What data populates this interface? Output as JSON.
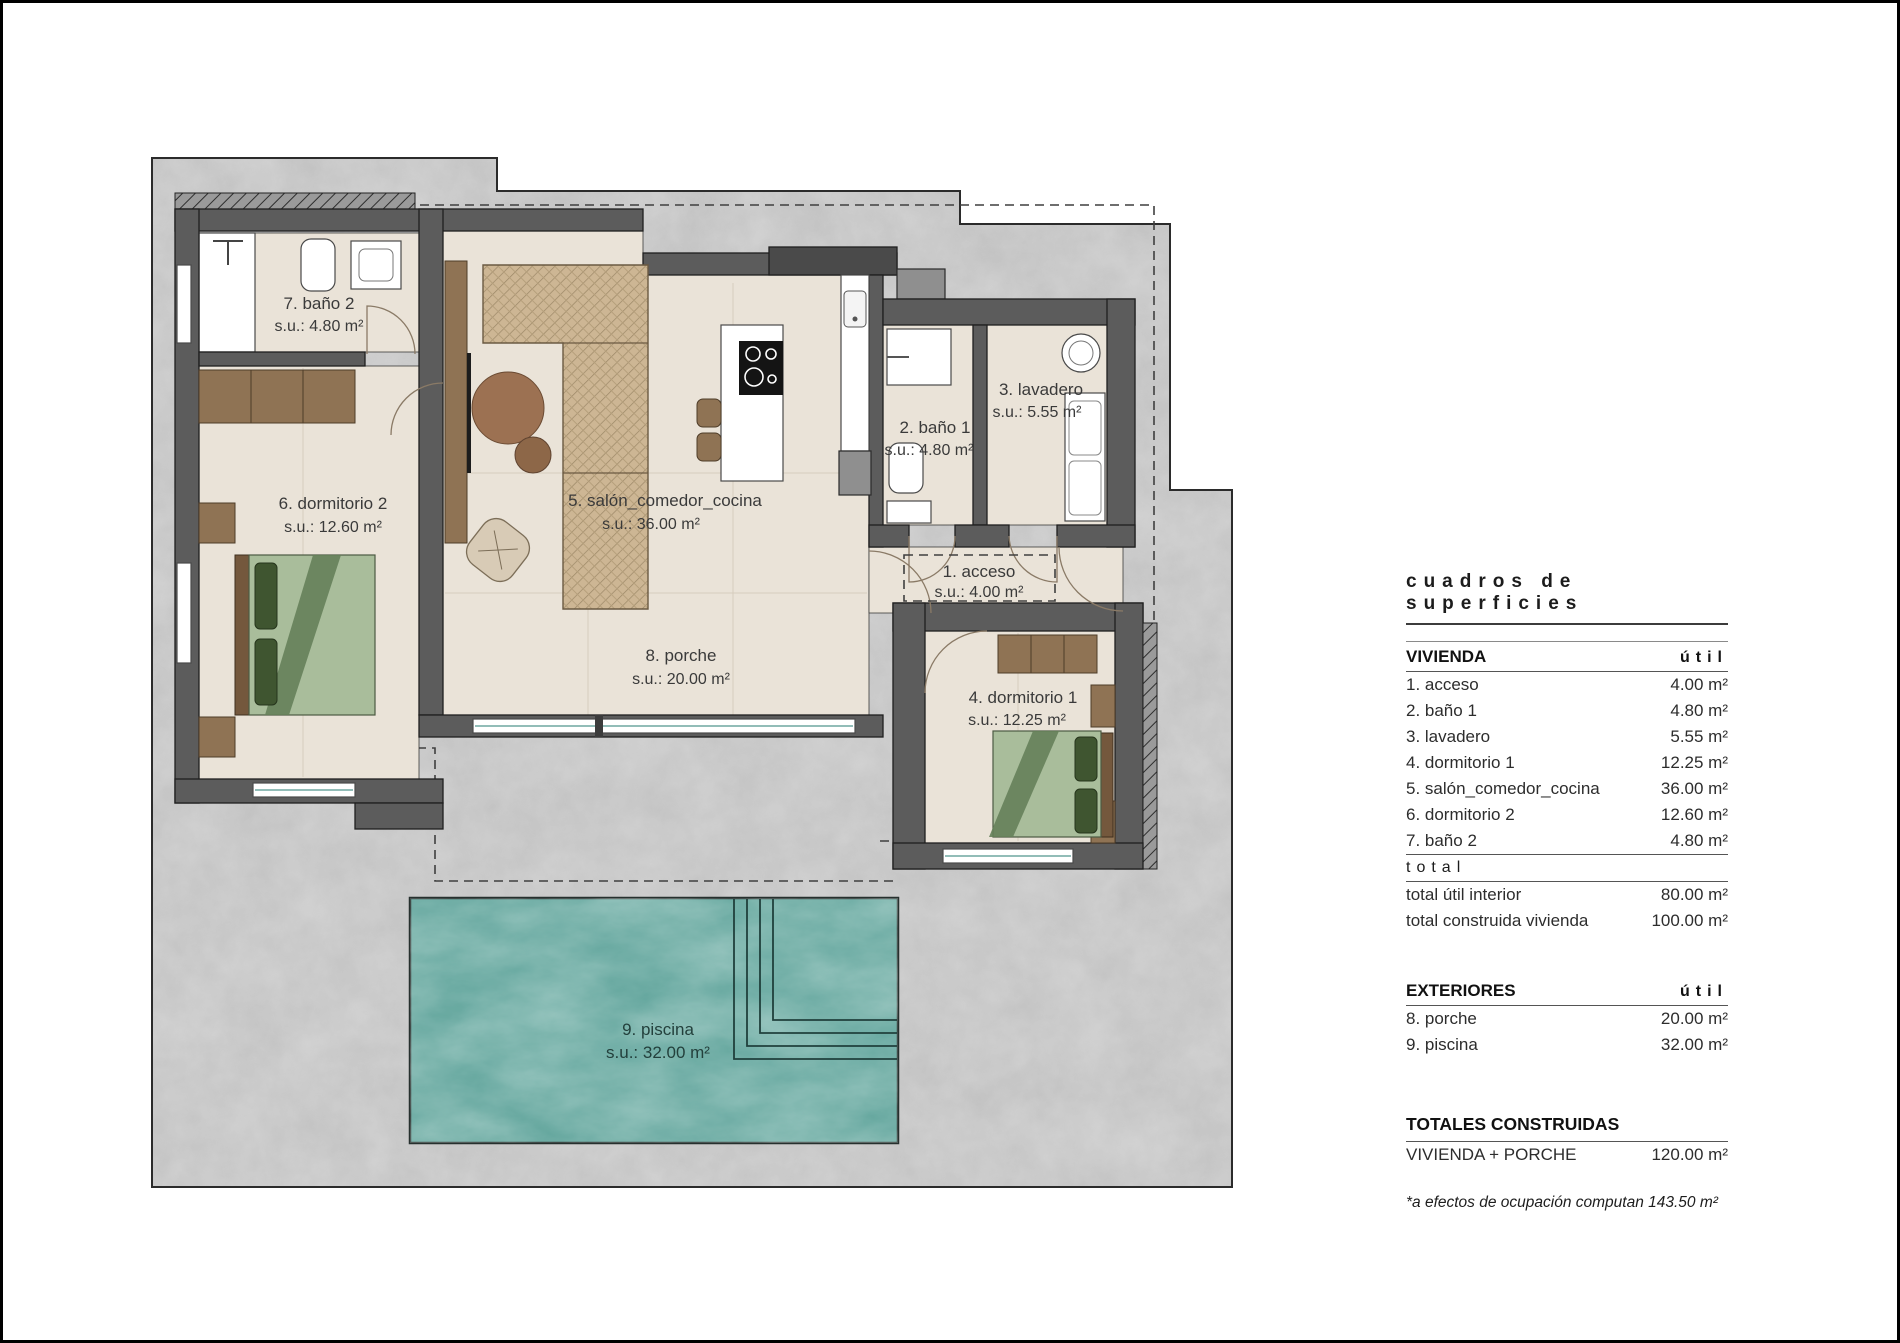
{
  "plan": {
    "rooms": {
      "acceso": {
        "label": "1. acceso",
        "area": "s.u.: 4.00 m²"
      },
      "banio1": {
        "label": "2. baño 1",
        "area": "s.u.: 4.80 m²"
      },
      "lavadero": {
        "label": "3. lavadero",
        "area": "s.u.: 5.55 m²"
      },
      "dormitorio1": {
        "label": "4. dormitorio 1",
        "area": "s.u.: 12.25 m²"
      },
      "salon": {
        "label": "5. salón_comedor_cocina",
        "area": "s.u.: 36.00 m²"
      },
      "dormitorio2": {
        "label": "6. dormitorio 2",
        "area": "s.u.: 12.60 m²"
      },
      "banio2": {
        "label": "7. baño 2",
        "area": "s.u.: 4.80 m²"
      },
      "porche": {
        "label": "8. porche",
        "area": "s.u.: 20.00 m²"
      },
      "piscina": {
        "label": "9. piscina",
        "area": "s.u.: 32.00 m²"
      }
    },
    "colors": {
      "pool": "#5ea39a",
      "terrain": "#c7c7c7",
      "wall": "#5c5c5c",
      "floor": "#eae3d8"
    }
  },
  "table": {
    "title": "cuadros de superficies",
    "vivienda": {
      "header": "VIVIENDA",
      "unit_col": "útil",
      "rows": [
        {
          "label": "1. acceso",
          "value": "4.00 m²"
        },
        {
          "label": "2. baño 1",
          "value": "4.80 m²"
        },
        {
          "label": "3. lavadero",
          "value": "5.55 m²"
        },
        {
          "label": "4. dormitorio 1",
          "value": "12.25 m²"
        },
        {
          "label": "5. salón_comedor_cocina",
          "value": "36.00 m²"
        },
        {
          "label": "6. dormitorio 2",
          "value": "12.60 m²"
        },
        {
          "label": "7. baño 2",
          "value": "4.80 m²"
        }
      ]
    },
    "total_label": "total",
    "totals": [
      {
        "label": "total útil interior",
        "value": "80.00 m²"
      },
      {
        "label": "total construida vivienda",
        "value": "100.00 m²"
      }
    ],
    "exteriores": {
      "header": "EXTERIORES",
      "unit_col": "útil",
      "rows": [
        {
          "label": "8. porche",
          "value": "20.00 m²"
        },
        {
          "label": "9. piscina",
          "value": "32.00 m²"
        }
      ]
    },
    "totales_construidas": {
      "header": "TOTALES CONSTRUIDAS",
      "rows": [
        {
          "label": "VIVIENDA + PORCHE",
          "value": "120.00 m²"
        }
      ]
    },
    "note": "*a efectos de ocupación computan 143.50 m²"
  }
}
